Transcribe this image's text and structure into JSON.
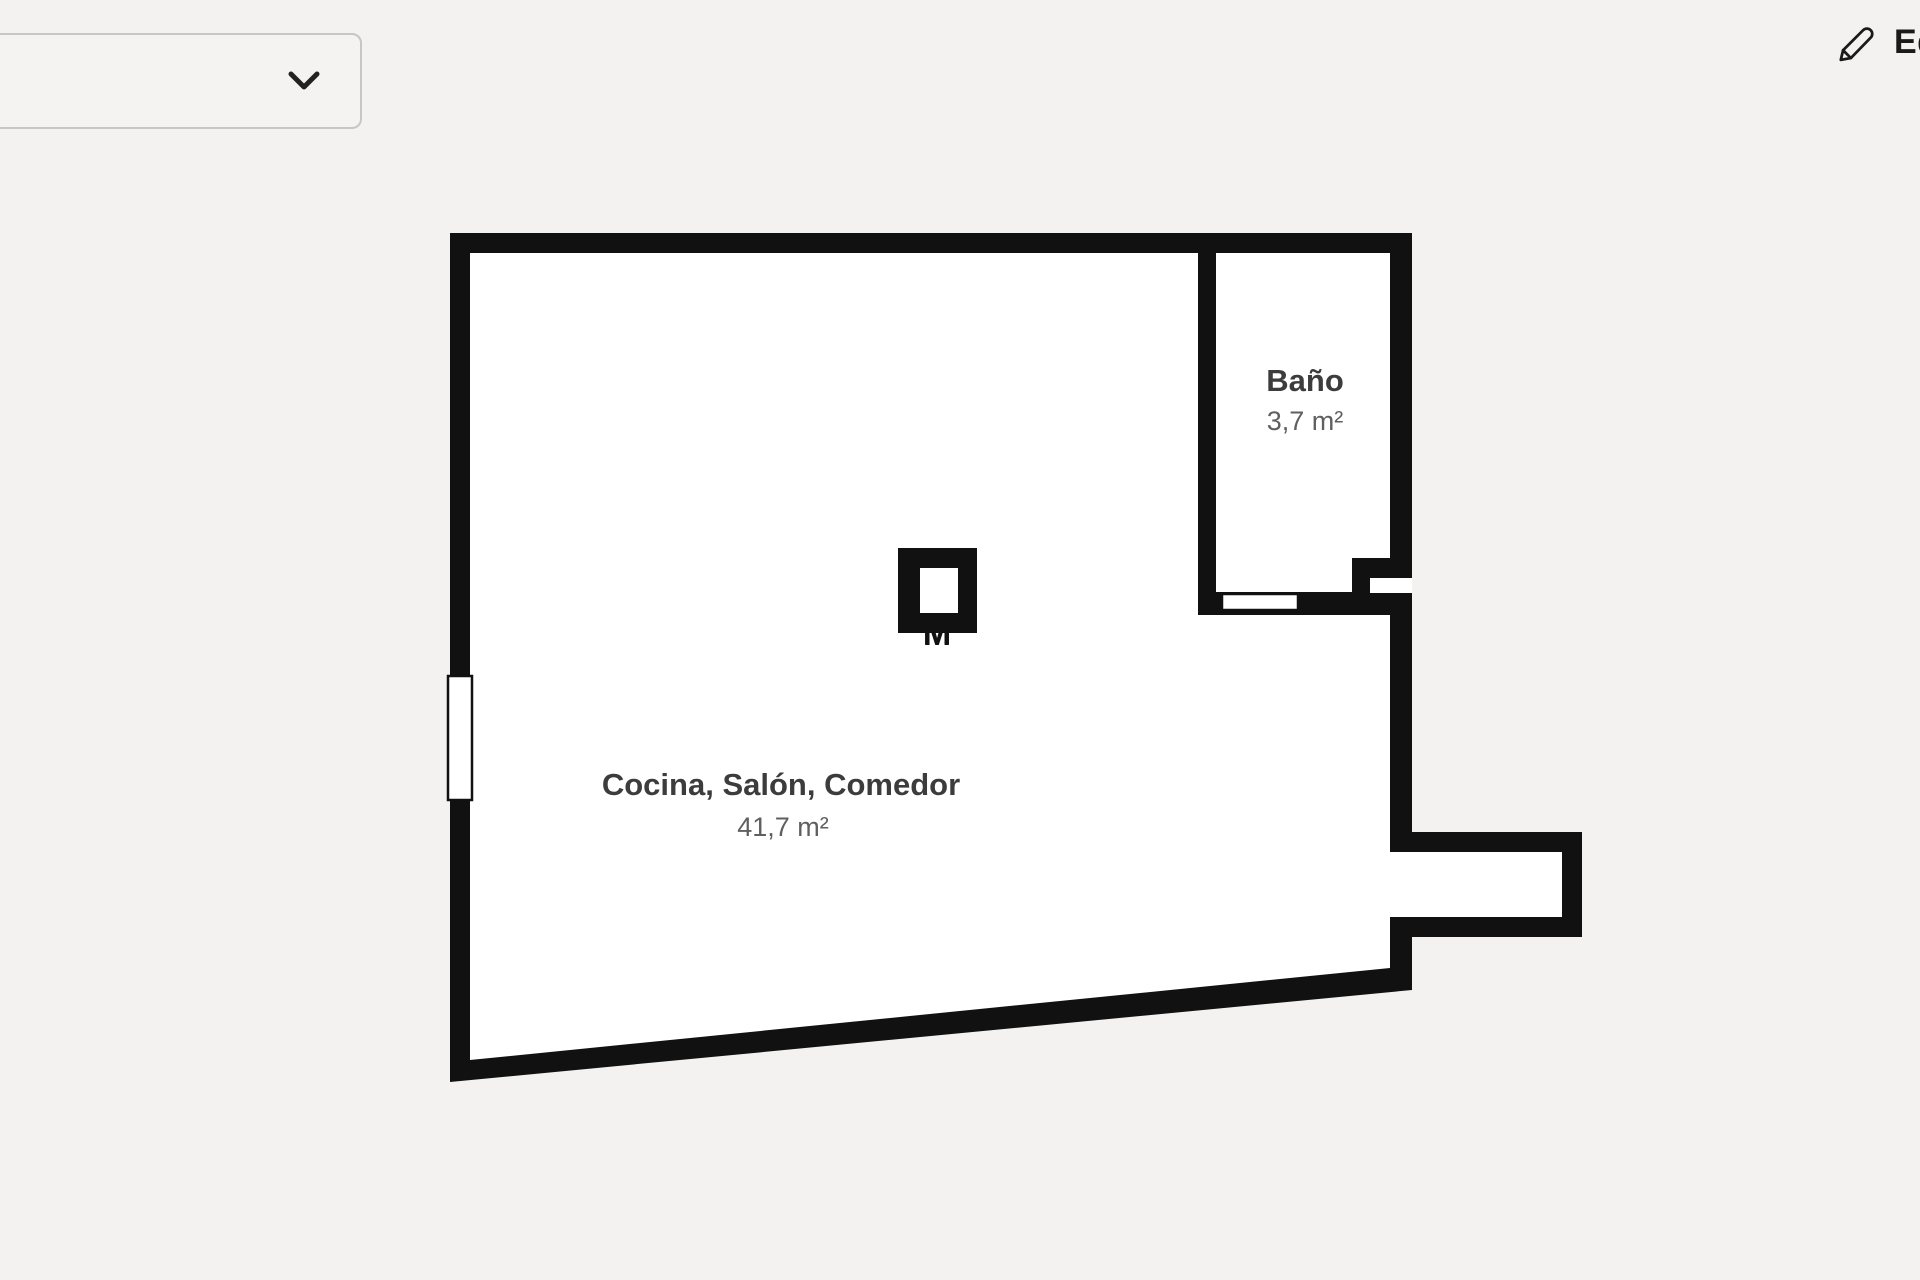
{
  "page": {
    "background_color": "#f3f2f0"
  },
  "toolbar": {
    "floor_selector": {
      "value": "",
      "icon": "chevron-down"
    },
    "edit_button": {
      "label": "Editar",
      "icon": "pencil"
    }
  },
  "floorplan": {
    "wall_color": "#111111",
    "floor_color": "#ffffff",
    "rooms": [
      {
        "name": "Cocina, Salón, Comedor",
        "area": "41,7 m²"
      },
      {
        "name": "Baño",
        "area": "3,7 m²"
      }
    ],
    "column_marker": "M",
    "features": [
      "window-left-wall",
      "bathroom-door-opening",
      "entrance-recess-right",
      "pillar-with-core"
    ]
  }
}
